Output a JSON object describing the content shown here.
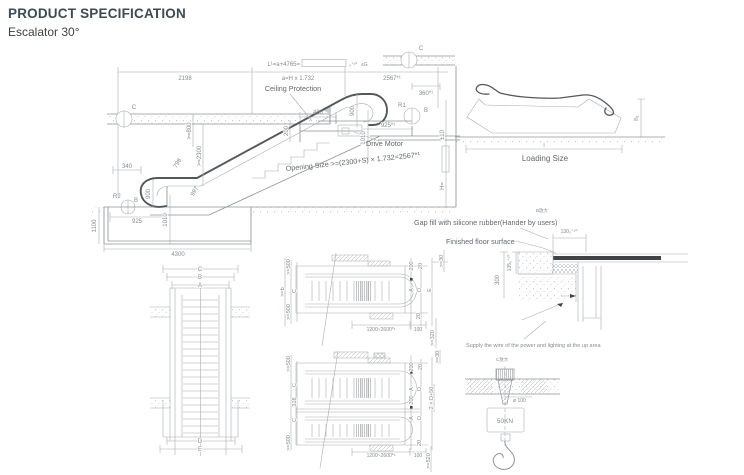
{
  "header": {
    "title": "PRODUCT SPECIFICATION",
    "subtitle": "Escalator 30°"
  },
  "elevation": {
    "dim_l_formula": "L¹=a+4765=",
    "dim_l_tol": "₀⁺¹⁰",
    "dim_l_suffix": "≤G",
    "dim_2198": "2198",
    "dim_ah": "a=H x 1.732",
    "dim_2567": "2567*¹",
    "dim_360": "360*¹",
    "ceiling_protection": "Ceiling Protection",
    "drive_motor": "Drive Motor",
    "opening_size": "Opening Size >=(2300+S) × 1.732=2567*¹",
    "dim_400": "400",
    "dim_200": "200",
    "dim_ge800": ">=800",
    "dim_ge2300": ">=2300",
    "dim_798": "798",
    "dim_997": "997",
    "dim_900_top": "900",
    "dim_1010_top": "1010",
    "dim_925_top": "925*¹",
    "dim_340": "340",
    "dim_900_left": "900",
    "dim_925_left": "925",
    "dim_1010_left": "1010",
    "dim_1100": "1100",
    "dim_4300": "4300",
    "dim_pm10": "±10",
    "dim_h": "H=",
    "marker_r1": "R1",
    "marker_r2": "R2",
    "marker_b": "B",
    "marker_c": "C"
  },
  "loading": {
    "label": "Loading Size",
    "dim_i": "i",
    "dim_h1": "h₁"
  },
  "notes": {
    "gap_fill": "Gap fill with silicone rubber(Hander by users)",
    "b_zoom": "B放大",
    "finished_floor": "Finished floor surface",
    "supply": "Supply the wire of the power and lighting at the up area",
    "c_zoom": "C放大"
  },
  "floor_detail": {
    "dim_130": "130₀⁺¹⁰",
    "dim_135": "135₀⁺¹⁰",
    "dim_300": "300"
  },
  "hook_detail": {
    "dim_phi": "ø 100",
    "load": "50KN"
  },
  "plan_left": {
    "c": "C",
    "b": "B",
    "a": "A",
    "d": "D",
    "e": "E"
  },
  "plan_upper": {
    "ge500_top": ">=500",
    "c": "C",
    "ge500_bot": ">=500",
    "ge_outer": ">=b",
    "dim_200": "200",
    "dim_20_top": "20",
    "a": "A",
    "d": "D",
    "e": "E",
    "dim_20_bot": "20",
    "range": "1200~2600*¹",
    "dim_100": "100",
    "ge320": ">=320",
    "ge30": ">=30"
  },
  "plan_lower": {
    "ge500_top": ">=500",
    "c1": "C",
    "dim_318": "318",
    "c2": "C",
    "ge500_bot": ">=500",
    "dim_200_top": "200",
    "dim_20_top": "20",
    "a1": "A",
    "d1": "D",
    "dim_200_mid": "200",
    "a2": "A",
    "d2": "D",
    "total": "2 × D+50",
    "dim_20_bot": "20",
    "range": "1200~2600*¹",
    "dim_100": "100",
    "ge520": ">=520",
    "ge30": ">=30"
  }
}
